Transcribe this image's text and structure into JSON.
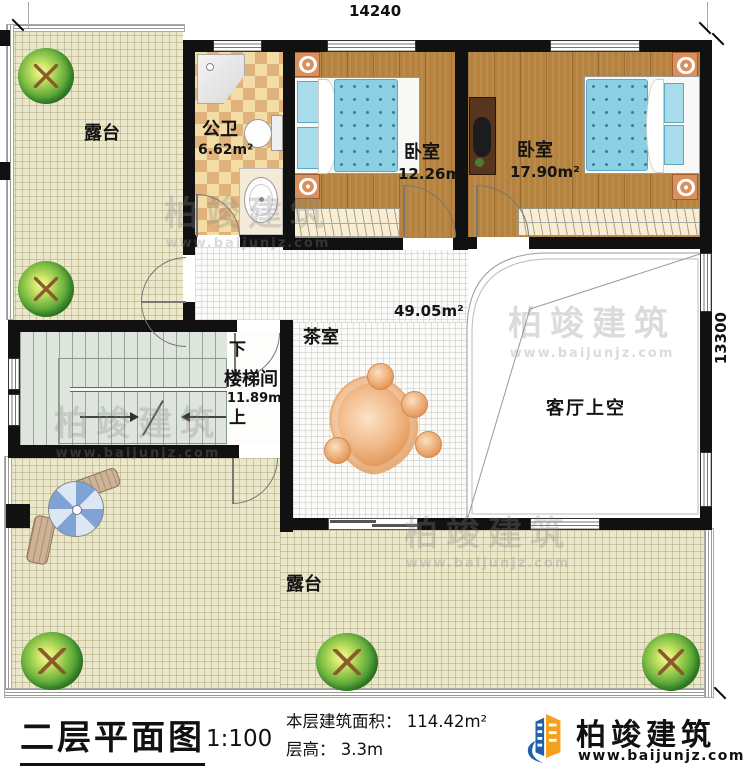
{
  "dimensions": {
    "width": "14240",
    "depth": "13300"
  },
  "rooms": {
    "terrace_top": "露台",
    "terrace_bottom": "露台",
    "bathroom_label": "公卫",
    "bathroom_area": "6.62m²",
    "bedroom1_label": "卧室",
    "bedroom1_area": "12.26m²",
    "bedroom2_label": "卧室",
    "bedroom2_area": "17.90m²",
    "tearoom_label": "茶室",
    "tearoom_area": "49.05m²",
    "stair_down": "下",
    "stair_label": "楼梯间",
    "stair_area": "11.89m²",
    "stair_up": "上",
    "void_label": "客厅上空"
  },
  "watermark": {
    "brand": "柏竣建筑",
    "site": "www.baijunjz.com"
  },
  "footer": {
    "title": "二层平面图",
    "scale": "1:100",
    "area_line": "本层建筑面积： 114.42m²",
    "height_line": "层高： 3.3m",
    "brand": "柏竣建筑",
    "site": "www.baijunjz.com"
  },
  "colors": {
    "wall": "#111111",
    "wood_floor": "#b5823f",
    "terrace": "#ebe7ca",
    "tile": "#e0b27c",
    "stairs": "#dee5dc",
    "mattress": "#8ccfe2",
    "tea_table": "#e09455",
    "brand_blue": "#1f5fae",
    "brand_orange": "#f6a01e"
  }
}
